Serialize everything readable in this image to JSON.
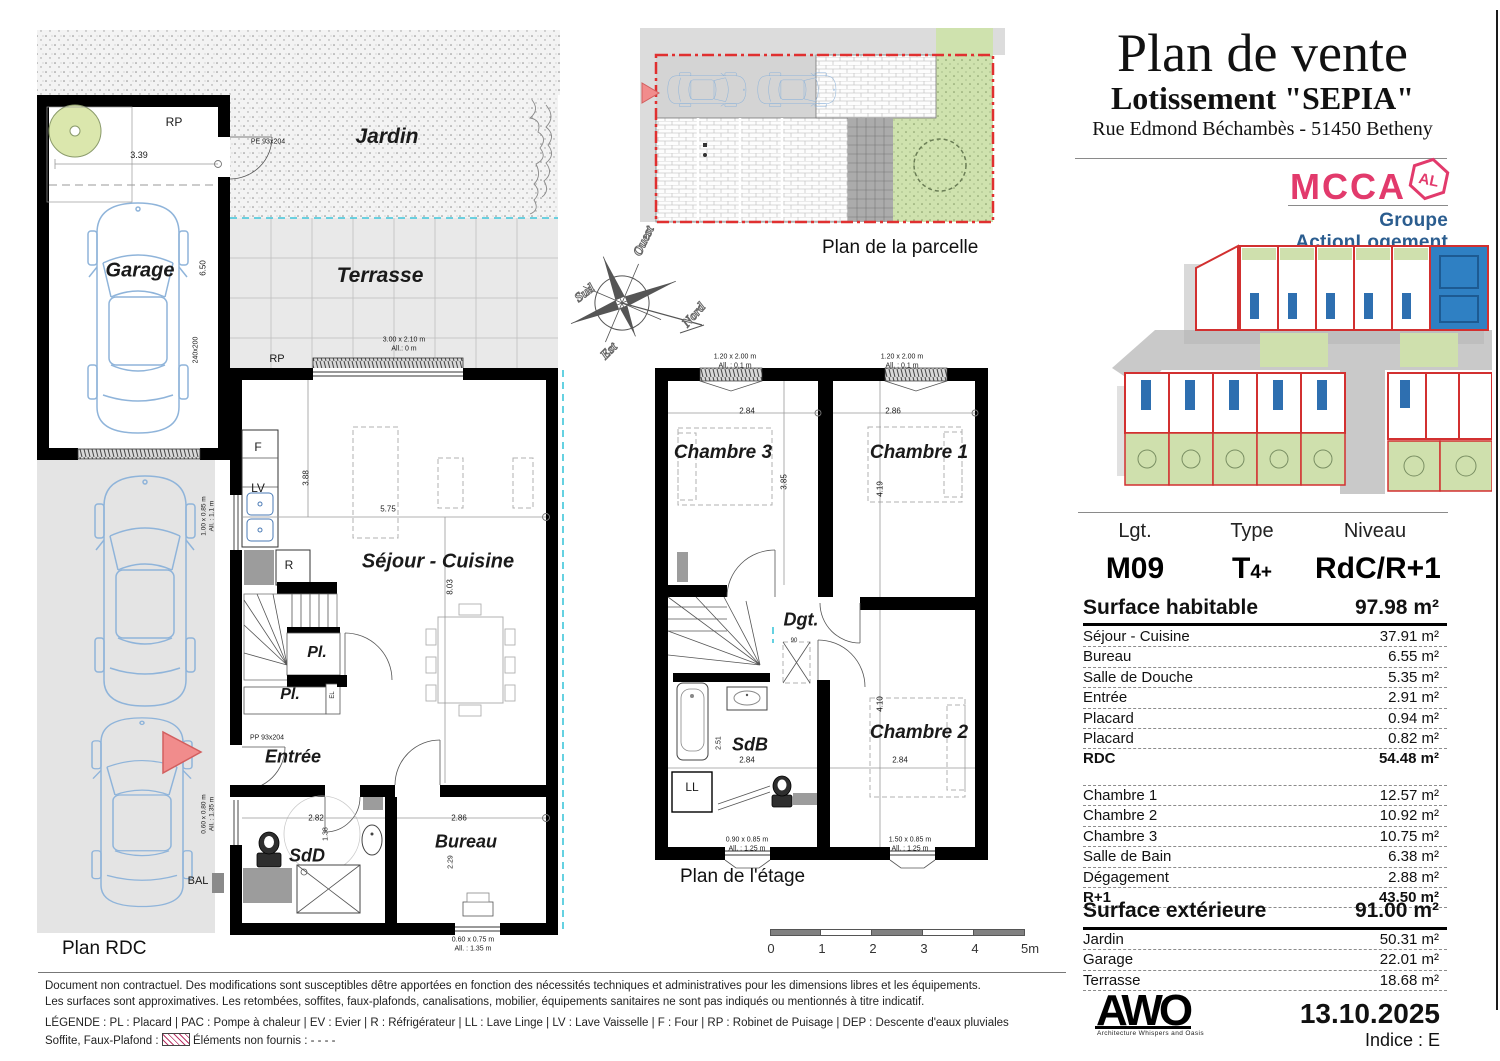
{
  "header": {
    "title": "Plan de vente",
    "subtitle": "Lotissement \"SEPIA\"",
    "address": "Rue Edmond Béchambès - 51450 Betheny"
  },
  "branding": {
    "mcca": "MCCA",
    "badge": "AL",
    "group": "Groupe ActionLogement",
    "mcca_color": "#e23a6c",
    "group_color": "#2b5d8f"
  },
  "captions": {
    "rdc": "Plan RDC",
    "etage": "Plan de l'étage",
    "parcelle": "Plan de la parcelle"
  },
  "compass": {
    "north": "Nord",
    "south": "Sud",
    "east": "Est",
    "west": "Ouest"
  },
  "scalebar": {
    "labels": [
      "0",
      "1",
      "2",
      "3",
      "4",
      "5m"
    ]
  },
  "info": {
    "col_headers": [
      "Lgt.",
      "Type",
      "Niveau"
    ],
    "lot": "M09",
    "type_t": "T",
    "type_sub": "4+",
    "niveau": "RdC/R+1",
    "sh_label": "Surface habitable",
    "sh_value": "97.98 m²",
    "rdc_rows": [
      {
        "label": "Séjour - Cuisine",
        "value": "37.91 m²"
      },
      {
        "label": "Bureau",
        "value": "6.55 m²"
      },
      {
        "label": "Salle de Douche",
        "value": "5.35 m²"
      },
      {
        "label": "Entrée",
        "value": "2.91 m²"
      },
      {
        "label": "Placard",
        "value": "0.94 m²"
      },
      {
        "label": "Placard",
        "value": "0.82 m²"
      },
      {
        "label": "RDC",
        "value": "54.48 m²",
        "bold": true
      }
    ],
    "r1_rows": [
      {
        "label": "Chambre 1",
        "value": "12.57 m²"
      },
      {
        "label": "Chambre 2",
        "value": "10.92 m²"
      },
      {
        "label": "Chambre 3",
        "value": "10.75 m²"
      },
      {
        "label": "Salle de Bain",
        "value": "6.38 m²"
      },
      {
        "label": "Dégagement",
        "value": "2.88 m²"
      },
      {
        "label": "R+1",
        "value": "43.50 m²",
        "bold": true
      }
    ],
    "se_label": "Surface extérieure",
    "se_value": "91.00 m²",
    "ext_rows": [
      {
        "label": "Jardin",
        "value": "50.31 m²"
      },
      {
        "label": "Garage",
        "value": "22.01 m²"
      },
      {
        "label": "Terrasse",
        "value": "18.68 m²"
      }
    ]
  },
  "footer": {
    "disclaimer1": "Document non contractuel. Des modifications sont susceptibles dêtre apportées en fonction des nécessités techniques et administratives pour les dimensions libres et les équipements.",
    "disclaimer2": "Les surfaces sont approximatives. Les retombées, soffites, faux-plafonds, canalisations, mobilier, équipements sanitaires ne sont pas indiqués ou mentionnés à titre indicatif.",
    "legend": "LÉGENDE : PL : Placard | PAC : Pompe à chaleur | EV : Evier |  R : Réfrigérateur | LL : Lave Linge | LV : Lave Vaisselle | F : Four | RP : Robinet de Puisage | DEP : Descente d'eaux pluviales",
    "legend2_prefix": "Soffite, Faux-Plafond :",
    "legend2_suffix": "Éléments non fournis : - - - -",
    "awo": "AWO",
    "awo_tagline": "Architecture Whispers and Oasis",
    "date": "13.10.2025",
    "indice": "Indice : E"
  },
  "plan_rdc": {
    "annotations": [
      {
        "t": "RP",
        "x": 174,
        "y": 122,
        "fs": 12
      },
      {
        "t": "3.39",
        "x": 139,
        "y": 155,
        "fs": 9
      },
      {
        "t": "Garage",
        "x": 140,
        "y": 271,
        "fs": 20,
        "b": 1,
        "it": 1
      },
      {
        "t": "6.50",
        "x": 203,
        "y": 268,
        "fs": 8,
        "rot": -90
      },
      {
        "t": "240x200",
        "x": 196,
        "y": 350,
        "fs": 7,
        "rot": -90
      },
      {
        "t": "Jardin",
        "x": 387,
        "y": 137,
        "fs": 21,
        "b": 1,
        "it": 1
      },
      {
        "t": "PE 93x204",
        "x": 268,
        "y": 142,
        "fs": 7
      },
      {
        "t": "Terrasse",
        "x": 380,
        "y": 276,
        "fs": 21,
        "b": 1,
        "it": 1
      },
      {
        "t": "RP",
        "x": 277,
        "y": 359,
        "fs": 11
      },
      {
        "t": "3.00 x 2.10 m",
        "x": 404,
        "y": 340,
        "fs": 7
      },
      {
        "t": "All.: 0 m",
        "x": 404,
        "y": 349,
        "fs": 7
      },
      {
        "t": "F",
        "x": 258,
        "y": 447,
        "fs": 12
      },
      {
        "t": "LV",
        "x": 258,
        "y": 488,
        "fs": 12
      },
      {
        "t": "3.88",
        "x": 306,
        "y": 478,
        "fs": 8,
        "rot": -90
      },
      {
        "t": "5.75",
        "x": 388,
        "y": 509,
        "fs": 8
      },
      {
        "t": "Séjour - Cuisine",
        "x": 438,
        "y": 562,
        "fs": 20,
        "b": 1,
        "it": 1
      },
      {
        "t": "R",
        "x": 289,
        "y": 565,
        "fs": 12
      },
      {
        "t": "8.03",
        "x": 450,
        "y": 587,
        "fs": 8,
        "rot": -90
      },
      {
        "t": "Pl.",
        "x": 317,
        "y": 653,
        "fs": 16,
        "b": 1,
        "it": 1
      },
      {
        "t": "Pl.",
        "x": 290,
        "y": 695,
        "fs": 16,
        "b": 1,
        "it": 1
      },
      {
        "t": "EL",
        "x": 333,
        "y": 695,
        "fs": 6,
        "rot": -90
      },
      {
        "t": "PP 93x204",
        "x": 267,
        "y": 738,
        "fs": 7
      },
      {
        "t": "Entrée",
        "x": 293,
        "y": 757,
        "fs": 18,
        "b": 1,
        "it": 1
      },
      {
        "t": "SdD",
        "x": 307,
        "y": 856,
        "fs": 18,
        "b": 1,
        "it": 1
      },
      {
        "t": "2.82",
        "x": 316,
        "y": 818,
        "fs": 8
      },
      {
        "t": "1.38",
        "x": 326,
        "y": 834,
        "fs": 7,
        "rot": -90
      },
      {
        "t": "Bureau",
        "x": 466,
        "y": 842,
        "fs": 18,
        "b": 1,
        "it": 1
      },
      {
        "t": "2.86",
        "x": 459,
        "y": 818,
        "fs": 8
      },
      {
        "t": "2.29",
        "x": 451,
        "y": 862,
        "fs": 7,
        "rot": -90
      },
      {
        "t": "0.60 x 0.75 m",
        "x": 473,
        "y": 940,
        "fs": 7
      },
      {
        "t": "All. : 1.35 m",
        "x": 473,
        "y": 949,
        "fs": 7
      },
      {
        "t": "1.00 x 0.85 m",
        "x": 204,
        "y": 516,
        "fs": 6.5,
        "rot": -90
      },
      {
        "t": "All. : 1.1 m",
        "x": 212,
        "y": 516,
        "fs": 6.5,
        "rot": -90
      },
      {
        "t": "0.60 x 0.80 m",
        "x": 204,
        "y": 814,
        "fs": 6.5,
        "rot": -90
      },
      {
        "t": "All. : 1.35 m",
        "x": 212,
        "y": 814,
        "fs": 6.5,
        "rot": -90
      },
      {
        "t": "BAL",
        "x": 198,
        "y": 881,
        "fs": 11
      }
    ]
  },
  "plan_etage": {
    "annotations": [
      {
        "t": "1.20 x 2.00 m",
        "x": 735,
        "y": 357,
        "fs": 7
      },
      {
        "t": "All. : 0.1 m",
        "x": 735,
        "y": 366,
        "fs": 7
      },
      {
        "t": "1.20 x 2.00 m",
        "x": 902,
        "y": 357,
        "fs": 7
      },
      {
        "t": "All. : 0.1 m",
        "x": 902,
        "y": 366,
        "fs": 7
      },
      {
        "t": "2.84",
        "x": 747,
        "y": 411,
        "fs": 8
      },
      {
        "t": "2.86",
        "x": 893,
        "y": 411,
        "fs": 8
      },
      {
        "t": "Chambre 3",
        "x": 723,
        "y": 453,
        "fs": 19,
        "b": 1,
        "it": 1
      },
      {
        "t": "Chambre 1",
        "x": 919,
        "y": 453,
        "fs": 19,
        "b": 1,
        "it": 1
      },
      {
        "t": "3.85",
        "x": 784,
        "y": 482,
        "fs": 8,
        "rot": -90
      },
      {
        "t": "4.19",
        "x": 880,
        "y": 489,
        "fs": 8,
        "rot": -90
      },
      {
        "t": "Dgt.",
        "x": 801,
        "y": 620,
        "fs": 18,
        "b": 1,
        "it": 1
      },
      {
        "t": "90",
        "x": 794,
        "y": 641,
        "fs": 6
      },
      {
        "t": "SdB",
        "x": 750,
        "y": 745,
        "fs": 18,
        "b": 1,
        "it": 1
      },
      {
        "t": "2.51",
        "x": 719,
        "y": 743,
        "fs": 7,
        "rot": -90
      },
      {
        "t": "2.84",
        "x": 747,
        "y": 760,
        "fs": 8
      },
      {
        "t": "4.10",
        "x": 880,
        "y": 704,
        "fs": 8,
        "rot": -90
      },
      {
        "t": "Chambre 2",
        "x": 919,
        "y": 733,
        "fs": 19,
        "b": 1,
        "it": 1
      },
      {
        "t": "2.84",
        "x": 900,
        "y": 760,
        "fs": 8
      },
      {
        "t": "LL",
        "x": 692,
        "y": 787,
        "fs": 12
      },
      {
        "t": "0.90 x 0.85 m",
        "x": 747,
        "y": 840,
        "fs": 7
      },
      {
        "t": "All. : 1.25 m",
        "x": 747,
        "y": 849,
        "fs": 7
      },
      {
        "t": "1.50 x 0.85 m",
        "x": 910,
        "y": 840,
        "fs": 7
      },
      {
        "t": "All. : 1.25 m",
        "x": 910,
        "y": 849,
        "fs": 7
      }
    ]
  }
}
